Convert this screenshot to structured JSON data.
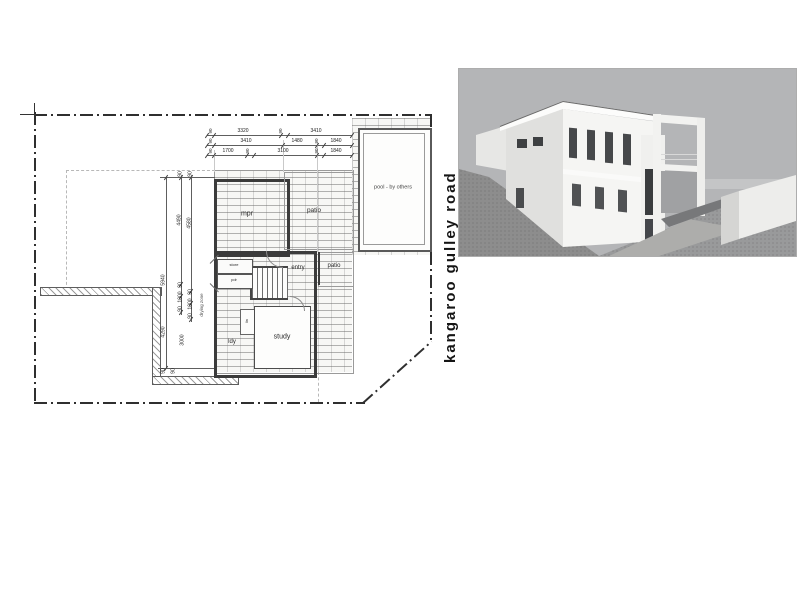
{
  "road_label": "kangaroo gulley road",
  "plan": {
    "rooms": {
      "mpr": "mpr",
      "patio_main": "patio",
      "patio_small": "patio",
      "entry": "entry",
      "study": "study",
      "laundry": "ldy",
      "store": "store",
      "powder": "pdr",
      "linen": "lin"
    },
    "pool_label": "pool - by others",
    "drying_zone_label": "drying zone",
    "dims_top": {
      "row1": [
        "90",
        "3320",
        "90",
        "3410"
      ],
      "row2": [
        "90",
        "3410",
        "1480",
        "90",
        "1840"
      ],
      "row3": [
        "90",
        "1700",
        "90",
        "3100",
        "90",
        "1840"
      ]
    },
    "dims_left": {
      "overall": "5940",
      "a": "4490",
      "b": "4580",
      "chain_a": [
        "90",
        "1000",
        "90"
      ],
      "chain_b": [
        "90",
        "1000",
        "90"
      ],
      "c": "4290",
      "d": "3000",
      "top_ticks": [
        "90",
        "90"
      ],
      "bottom_ticks": [
        "90",
        "90"
      ]
    }
  },
  "render_palette": {
    "sky": "#b4b5b7",
    "ground": "#999a9b",
    "hill_shadow": "#8d8d8d",
    "wall_light": "#f5f5f3",
    "wall_shade": "#e0e0de",
    "window": "#46484a"
  }
}
